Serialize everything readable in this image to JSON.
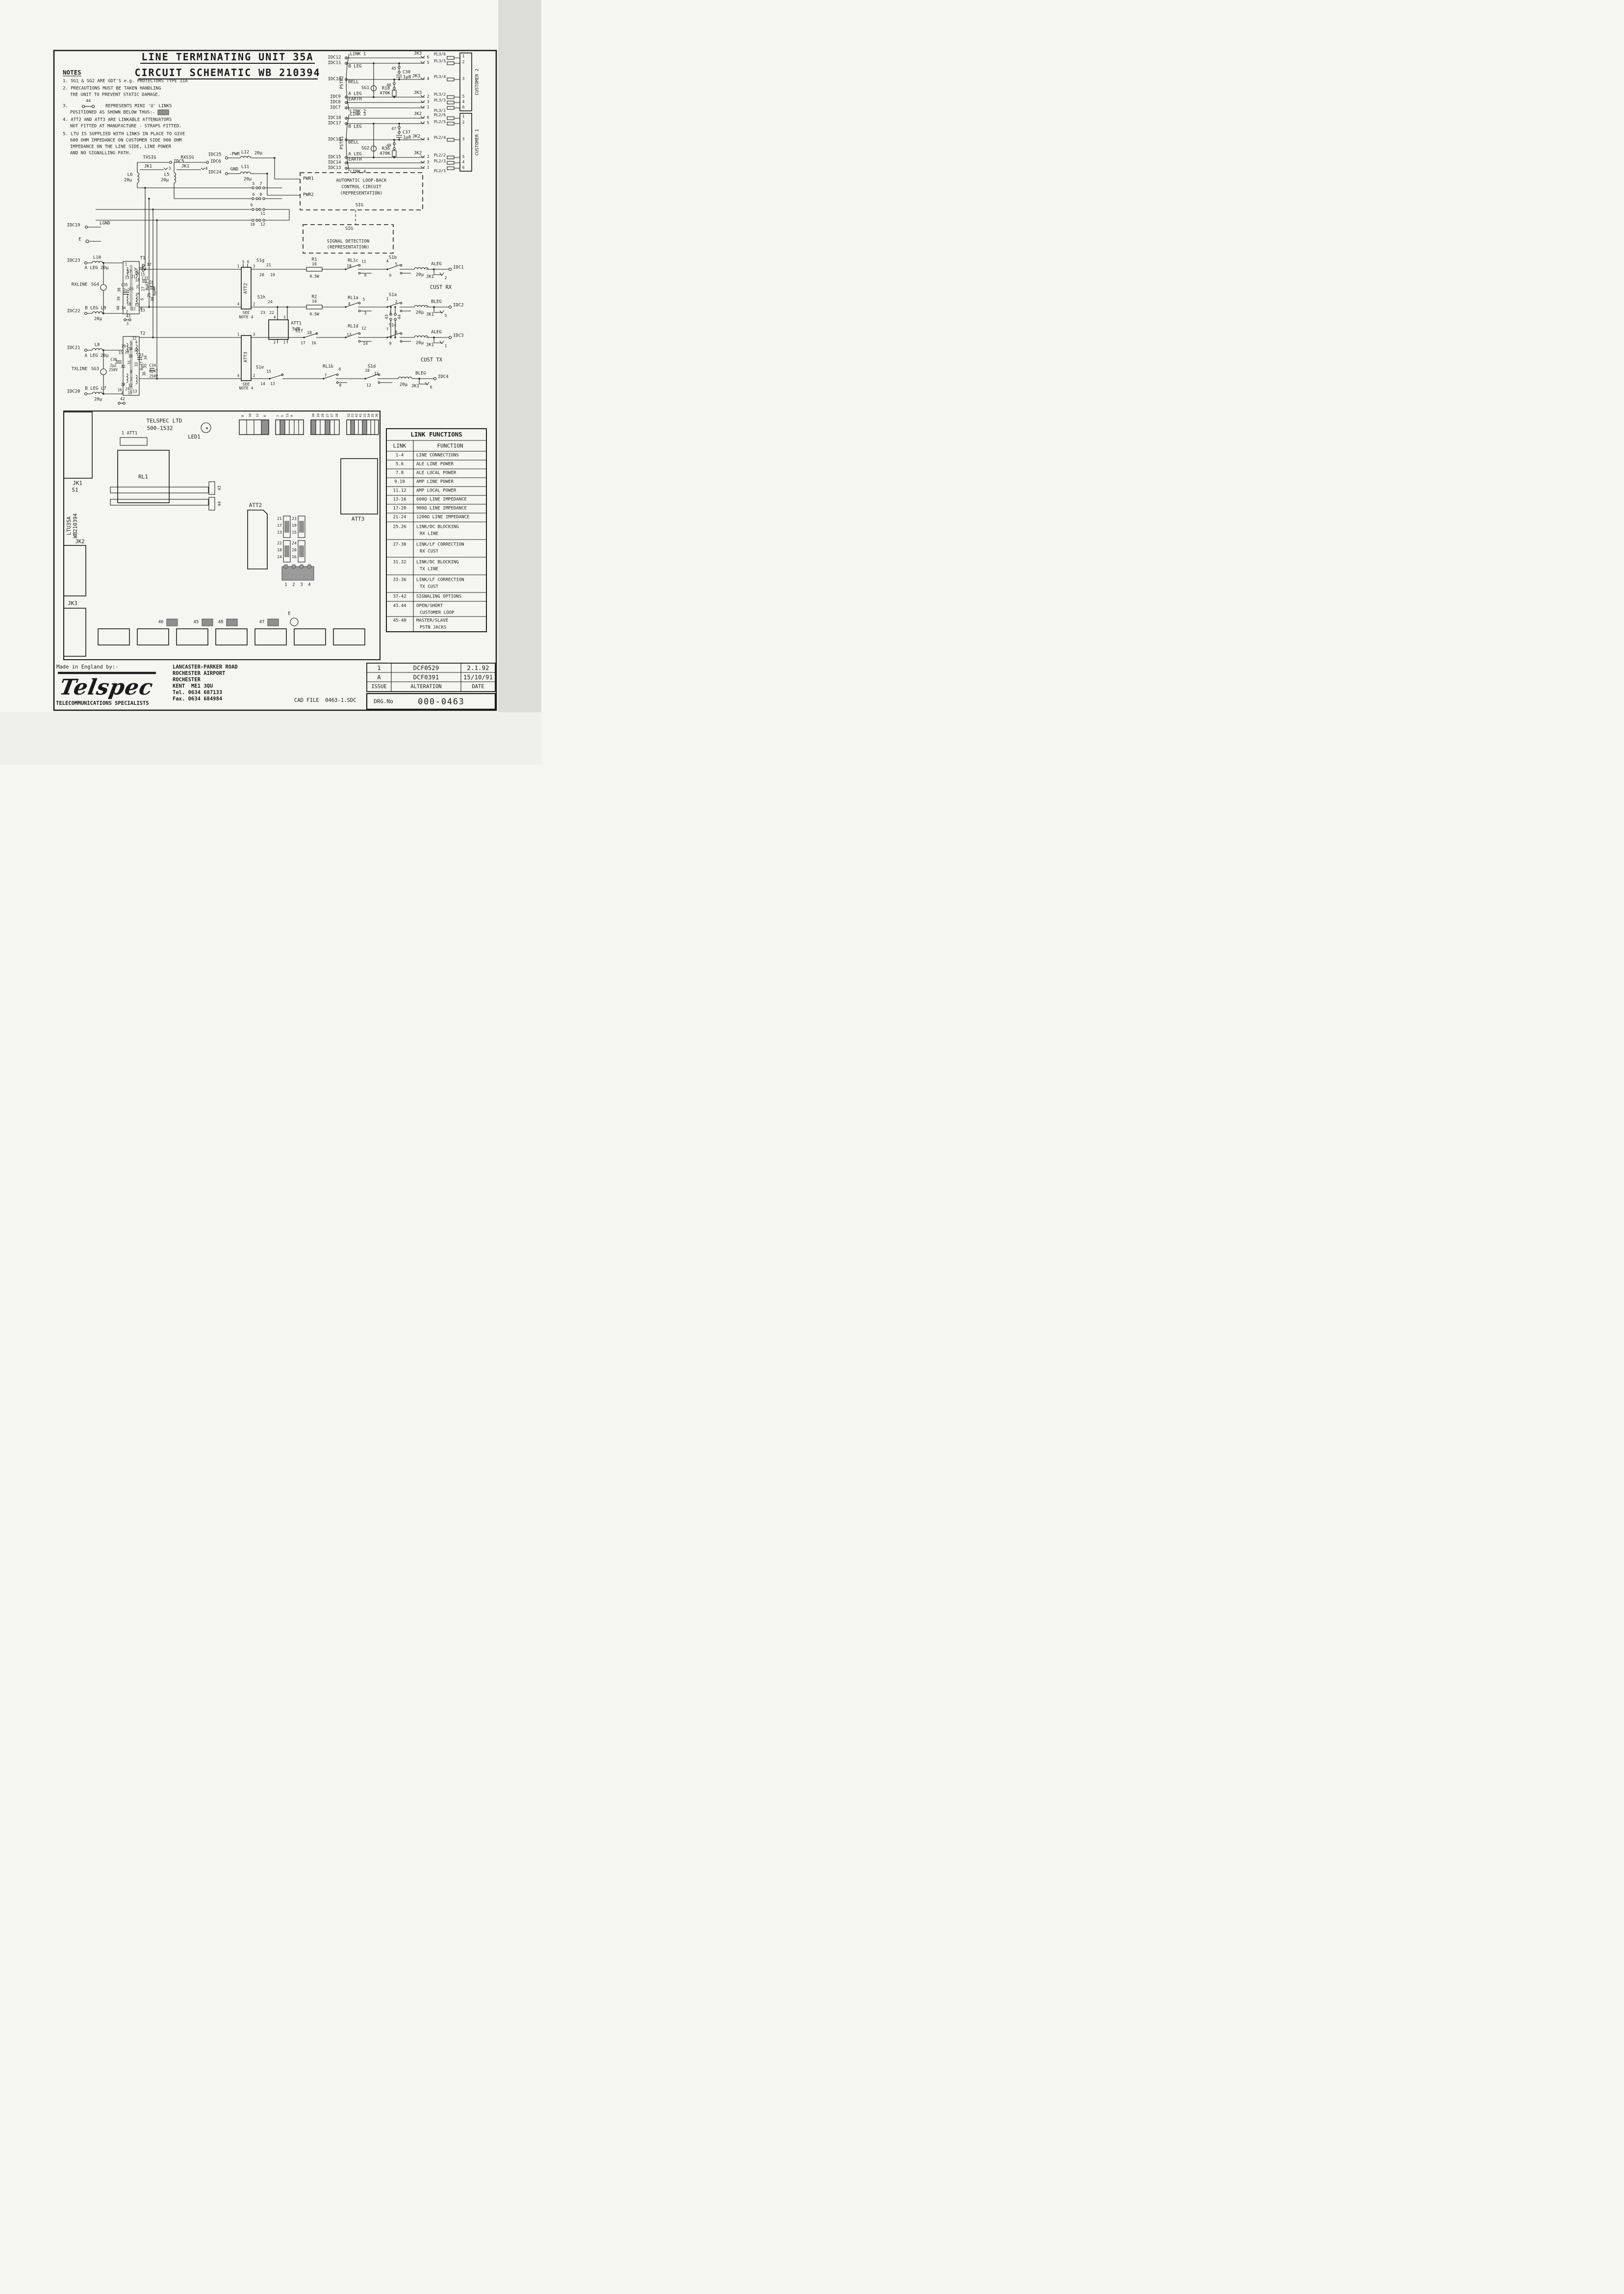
{
  "title": {
    "line1": "LINE TERMINATING UNIT 35A",
    "line2": "CIRCUIT SCHEMATIC WB 210394"
  },
  "notes": {
    "heading": "NOTES",
    "n1": "1. SG1 & SG2 ARE GDT'S e.g. PROTECTORS TYPE 11A",
    "n2a": "2. PRECAUTIONS MUST BE TAKEN HANDLING",
    "n2b": "THE UNIT TO PREVENT STATIC DAMAGE.",
    "n3a": "3.",
    "n3b": "REPRESENTS MINI 'U' LINKS",
    "n3c": "POSITIONED AS SHOWN BELOW THUS:-",
    "n4a": "4. ATT2 AND ATT3 ARE LINKABLE ATTENUATORS",
    "n4b": "NOT FITTED AT MANUFACTURE - STRAPS FITTED.",
    "n5a": "5. LTU IS SUPPLIED WITH LINKS IN PLACE TO GIVE",
    "n5b": "600 OHM IMPEDANCE ON CUSTOMER SIDE 900 OHM",
    "n5c": "IMPEDANCE ON THE LINE SIDE, LINE POWER",
    "n5d": "AND NO SIGNALLING PATH."
  },
  "n": {
    "1": "1",
    "2": "2",
    "3": "3",
    "4": "4",
    "5": "5",
    "6": "6",
    "7": "7",
    "8": "8",
    "9": "9",
    "10": "10",
    "11": "11",
    "12": "12",
    "13": "13",
    "14": "14",
    "15": "15",
    "16": "16",
    "17": "17",
    "18": "18",
    "19": "19",
    "20": "20",
    "21": "21",
    "22": "22",
    "23": "23",
    "24": "24",
    "25": "25",
    "26": "26",
    "27": "27",
    "28": "28",
    "29": "29",
    "30": "30",
    "31": "31",
    "32": "32",
    "33": "33",
    "34": "34",
    "35": "35",
    "36": "36",
    "37": "37",
    "38": "38",
    "39": "39",
    "40": "40",
    "41": "41",
    "42": "42",
    "43": "43",
    "44": "44",
    "45": "45",
    "46": "46",
    "47": "47",
    "48": "48"
  },
  "pstn2": {
    "group": "PSTN2",
    "customer": "CUSTOMER 2",
    "jk": "JK3",
    "sg": "SG1",
    "r": "R18",
    "rv": "470K",
    "c": "C30",
    "cv": "1µ8",
    "idc": [
      "IDC12",
      "IDC11",
      "IDC10",
      "IDC9",
      "IDC8",
      "IDC7"
    ],
    "wire": [
      "LINK 1",
      "B LEG",
      "BELL",
      "A LEG",
      "EARTH",
      "LINK 2"
    ],
    "jkpins": [
      "6",
      "5",
      "4",
      "2",
      "3",
      "1"
    ],
    "pl": [
      "PL3/6",
      "PL3/5",
      "PL3/4",
      "PL3/2",
      "PL3/3",
      "PL3/1"
    ],
    "custpins": [
      "1",
      "2",
      "3",
      "5",
      "4",
      "6"
    ]
  },
  "pstn1": {
    "group": "PSTN1",
    "customer": "CUSTOMER 1",
    "jk": "JK2",
    "sg": "SG2",
    "r": "R36",
    "rv": "470K",
    "c": "C37",
    "cv": "1µ8",
    "idc": [
      "IDC18",
      "IDC17",
      "IDC16",
      "IDC15",
      "IDC14",
      "IDC13"
    ],
    "wire": [
      "LINK 3",
      "B LEG",
      "BELL",
      "A LEG",
      "EARTH",
      "LINK 4"
    ],
    "jkpins": [
      "6",
      "5",
      "4",
      "2",
      "3",
      "1"
    ],
    "pl": [
      "PL2/6",
      "PL2/5",
      "PL2/4",
      "PL2/2",
      "PL2/3",
      "PL2/1"
    ],
    "custpins": [
      "1",
      "2",
      "3",
      "5",
      "4",
      "6"
    ]
  },
  "mid": {
    "txsig": "TXSIG",
    "rxsig": "RXSIG",
    "idc5": "IDC5",
    "idc6": "IDC6",
    "jk1": "JK1",
    "l6": "L6",
    "l5": "L5",
    "l12": "L12",
    "l11": "L11",
    "u20": "20µ",
    "npwr": "-PWR",
    "gnd": "GND",
    "idc25": "IDC25",
    "idc24": "IDC24",
    "pwr1": "PWR1",
    "pwr2": "PWR2",
    "sig": "SIG",
    "lb1": "AUTOMATIC LOOP-BACK",
    "lb2": "CONTROL CIRCUIT",
    "lb3": "(REPRESENTATION)",
    "sd1": "SIGNAL DETECTION",
    "sd2": "(REPRESENTATION)",
    "idc19": "IDC19",
    "lgnd": "LGND",
    "e": "E"
  },
  "sch": {
    "idc23": "IDC23",
    "idc22": "IDC22",
    "idc21": "IDC21",
    "idc20": "IDC20",
    "l10": "L10",
    "l8": "L8",
    "aleg20": "A LEG 20µ",
    "blegl9": "B LEG L9",
    "blegl7": "B LEG L7",
    "u20": "20µ",
    "rxline": "RXLINE",
    "txline": "TXLINE",
    "sg4": "SG4",
    "sg3": "SG3",
    "t1": "T1",
    "t2": "T2",
    "c35": "C35",
    "c36": "C36",
    "c31": "C31",
    "c32": "C32",
    "c33": "C33",
    "c34": "C34",
    "v2u2": "2µ2",
    "v0u47": "0µ47",
    "v250": "250V",
    "att1": "ATT1",
    "att2": "ATT2",
    "att3": "ATT3",
    "db": "5dB",
    "see": "SEE",
    "note4": "NOTE 4",
    "s1a": "S1a",
    "s1b": "S1b",
    "s1c": "S1c",
    "s1d": "S1d",
    "s1e": "S1e",
    "s1f": "S1f",
    "s1g": "S1g",
    "s1h": "S1h",
    "rl1a": "RL1a",
    "rl1b": "RL1b",
    "rl1c": "RL1c",
    "rl1d": "RL1d",
    "r1": "R1",
    "r2": "R2",
    "r10": "10",
    "hw": "0.5W",
    "aleg": "ALEG",
    "bleg": "BLEG",
    "idc1": "IDC1",
    "idc2": "IDC2",
    "idc3": "IDC3",
    "idc4": "IDC4",
    "jk1": "JK1",
    "custrx": "CUST RX",
    "custtx": "CUST TX"
  },
  "board": {
    "maker": "TELSPEC LTD",
    "part": "500-1532",
    "led1": "LED1",
    "att1ref": "1 ATT1",
    "rl1": "RL1",
    "s1": "S1",
    "jk1": "JK1",
    "jk2": "JK2",
    "jk3": "JK3",
    "att2": "ATT2",
    "att3": "ATT3",
    "ltu": "LTU35A",
    "wb": "WB210394",
    "e": "E",
    "strip1": [
      "8",
      "10",
      "12",
      "6"
    ],
    "strip2": [
      "7",
      "5",
      "11",
      "9"
    ],
    "strip3": [
      "30",
      "29",
      "28",
      "27",
      "37",
      "38"
    ],
    "strip4": [
      "32",
      "31",
      "42",
      "41",
      "33",
      "34",
      "35",
      "36"
    ],
    "dip": [
      "1",
      "2",
      "3",
      "4"
    ],
    "blkL1": [
      "21",
      "17",
      "13"
    ],
    "blkR1": [
      "23",
      "19",
      "15"
    ],
    "blkL2": [
      "22",
      "18",
      "14"
    ],
    "blkR2": [
      "24",
      "20",
      "16"
    ]
  },
  "table": {
    "title": "LINK FUNCTIONS",
    "h1": "LINK",
    "h2": "FUNCTION",
    "rows": [
      {
        "l": "1-4",
        "f1": "LINE CONNECTIONS",
        "f2": ""
      },
      {
        "l": "5.6",
        "f1": "ALE LINE POWER",
        "f2": ""
      },
      {
        "l": "7.8",
        "f1": "ALE LOCAL POWER",
        "f2": ""
      },
      {
        "l": "9.10",
        "f1": "AMP LINE POWER",
        "f2": ""
      },
      {
        "l": "11.12",
        "f1": "AMP LOCAL POWER",
        "f2": ""
      },
      {
        "l": "13-16",
        "f1": "600Ω LINE IMPEDANCE",
        "f2": ""
      },
      {
        "l": "17-20",
        "f1": "900Ω LINE IMPEDANCE",
        "f2": ""
      },
      {
        "l": "21-24",
        "f1": "1200Ω LINE IMPEDANCE",
        "f2": ""
      },
      {
        "l": "25.26",
        "f1": "LINK/DC BLOCKING",
        "f2": "RX LINE"
      },
      {
        "l": "27-30",
        "f1": "LINK/LF CORRECTION",
        "f2": "RX CUST"
      },
      {
        "l": "31.32",
        "f1": "LINK/DC BLOCKING",
        "f2": "TX LINE"
      },
      {
        "l": "33-36",
        "f1": "LINK/LF CORRECTION",
        "f2": "TX CUST"
      },
      {
        "l": "37-42",
        "f1": "SIGNALING OPTIONS",
        "f2": ""
      },
      {
        "l": "43.44",
        "f1": "OPEN/SHORT",
        "f2": "CUSTOMER LOOP"
      },
      {
        "l": "45-48",
        "f1": "MASTER/SLAVE",
        "f2": "PSTN JACKS"
      }
    ]
  },
  "footer": {
    "made": "Made in England by:-",
    "logo": "Telspec",
    "tag": "TELECOMMUNICATIONS SPECIALISTS",
    "addr": [
      "LANCASTER-PARKER ROAD",
      "ROCHESTER AIRPORT",
      "ROCHESTER",
      "KENT  ME1 3QU",
      "Tel. 0634 687133",
      "Fax. 0634 684984"
    ],
    "cad": "CAD FILE  0463-1.SDC"
  },
  "tb": {
    "hissue": "ISSUE",
    "halt": "ALTERATION",
    "hdate": "DATE",
    "drg": "DRG.No",
    "no": "000-0463",
    "rows": [
      {
        "issue": "1",
        "alt": "DCF0529",
        "date": "2.1.92"
      },
      {
        "issue": "A",
        "alt": "DCF0391",
        "date": "15/10/91"
      }
    ]
  }
}
